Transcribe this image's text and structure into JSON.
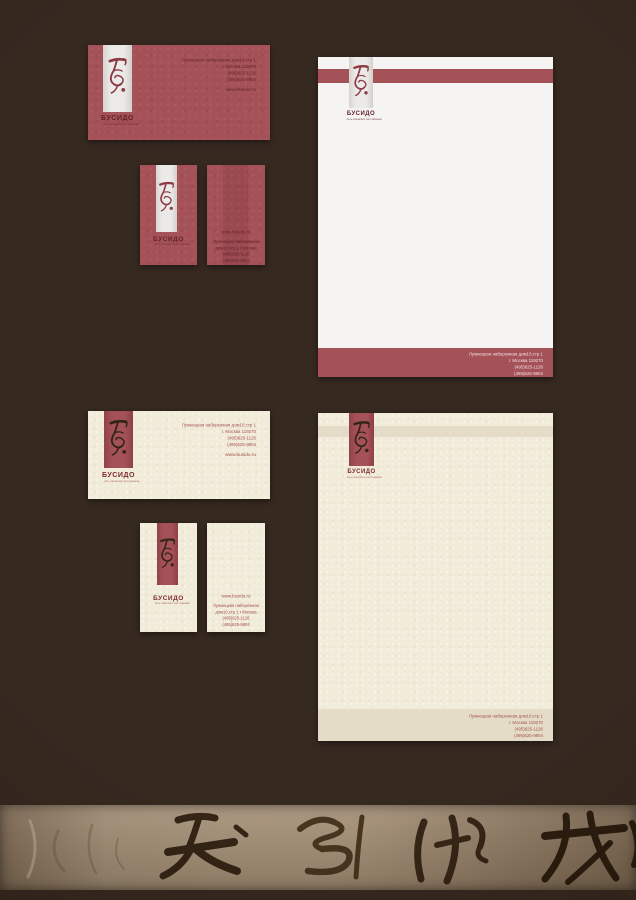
{
  "brand": {
    "name": "БУСИДО",
    "tagline": "сеть японских ресторанов",
    "website": "www.busido.ru"
  },
  "contact": {
    "address": "Лужнецкая набережная дом10,стр 1",
    "city": "г. Москва 119270",
    "phone1": "(495)625-1126",
    "phone2": "(495)625-9804",
    "website": "www.busido.ru"
  },
  "card_back": {
    "website": "www.busido.ru",
    "address1": "Лужнецкая набережная",
    "address2": "дом10,стр 1 • Москва",
    "phone1": "(495)625-1126",
    "phone2": "(495)625-9804"
  },
  "colors": {
    "background": "#362920",
    "red": "#a55158",
    "red_dark_text": "#62242a",
    "maroon_logo": "#8d3a42",
    "paper_white": "#f5f4f2",
    "cream": "#f1ebd9",
    "beige_band": "#e4dcc6",
    "ink_dark": "#342519",
    "red_on_cream": "#a4514e",
    "footer_text": "#f2e2e2",
    "calligraphy_ink": "#2b1c0e"
  }
}
